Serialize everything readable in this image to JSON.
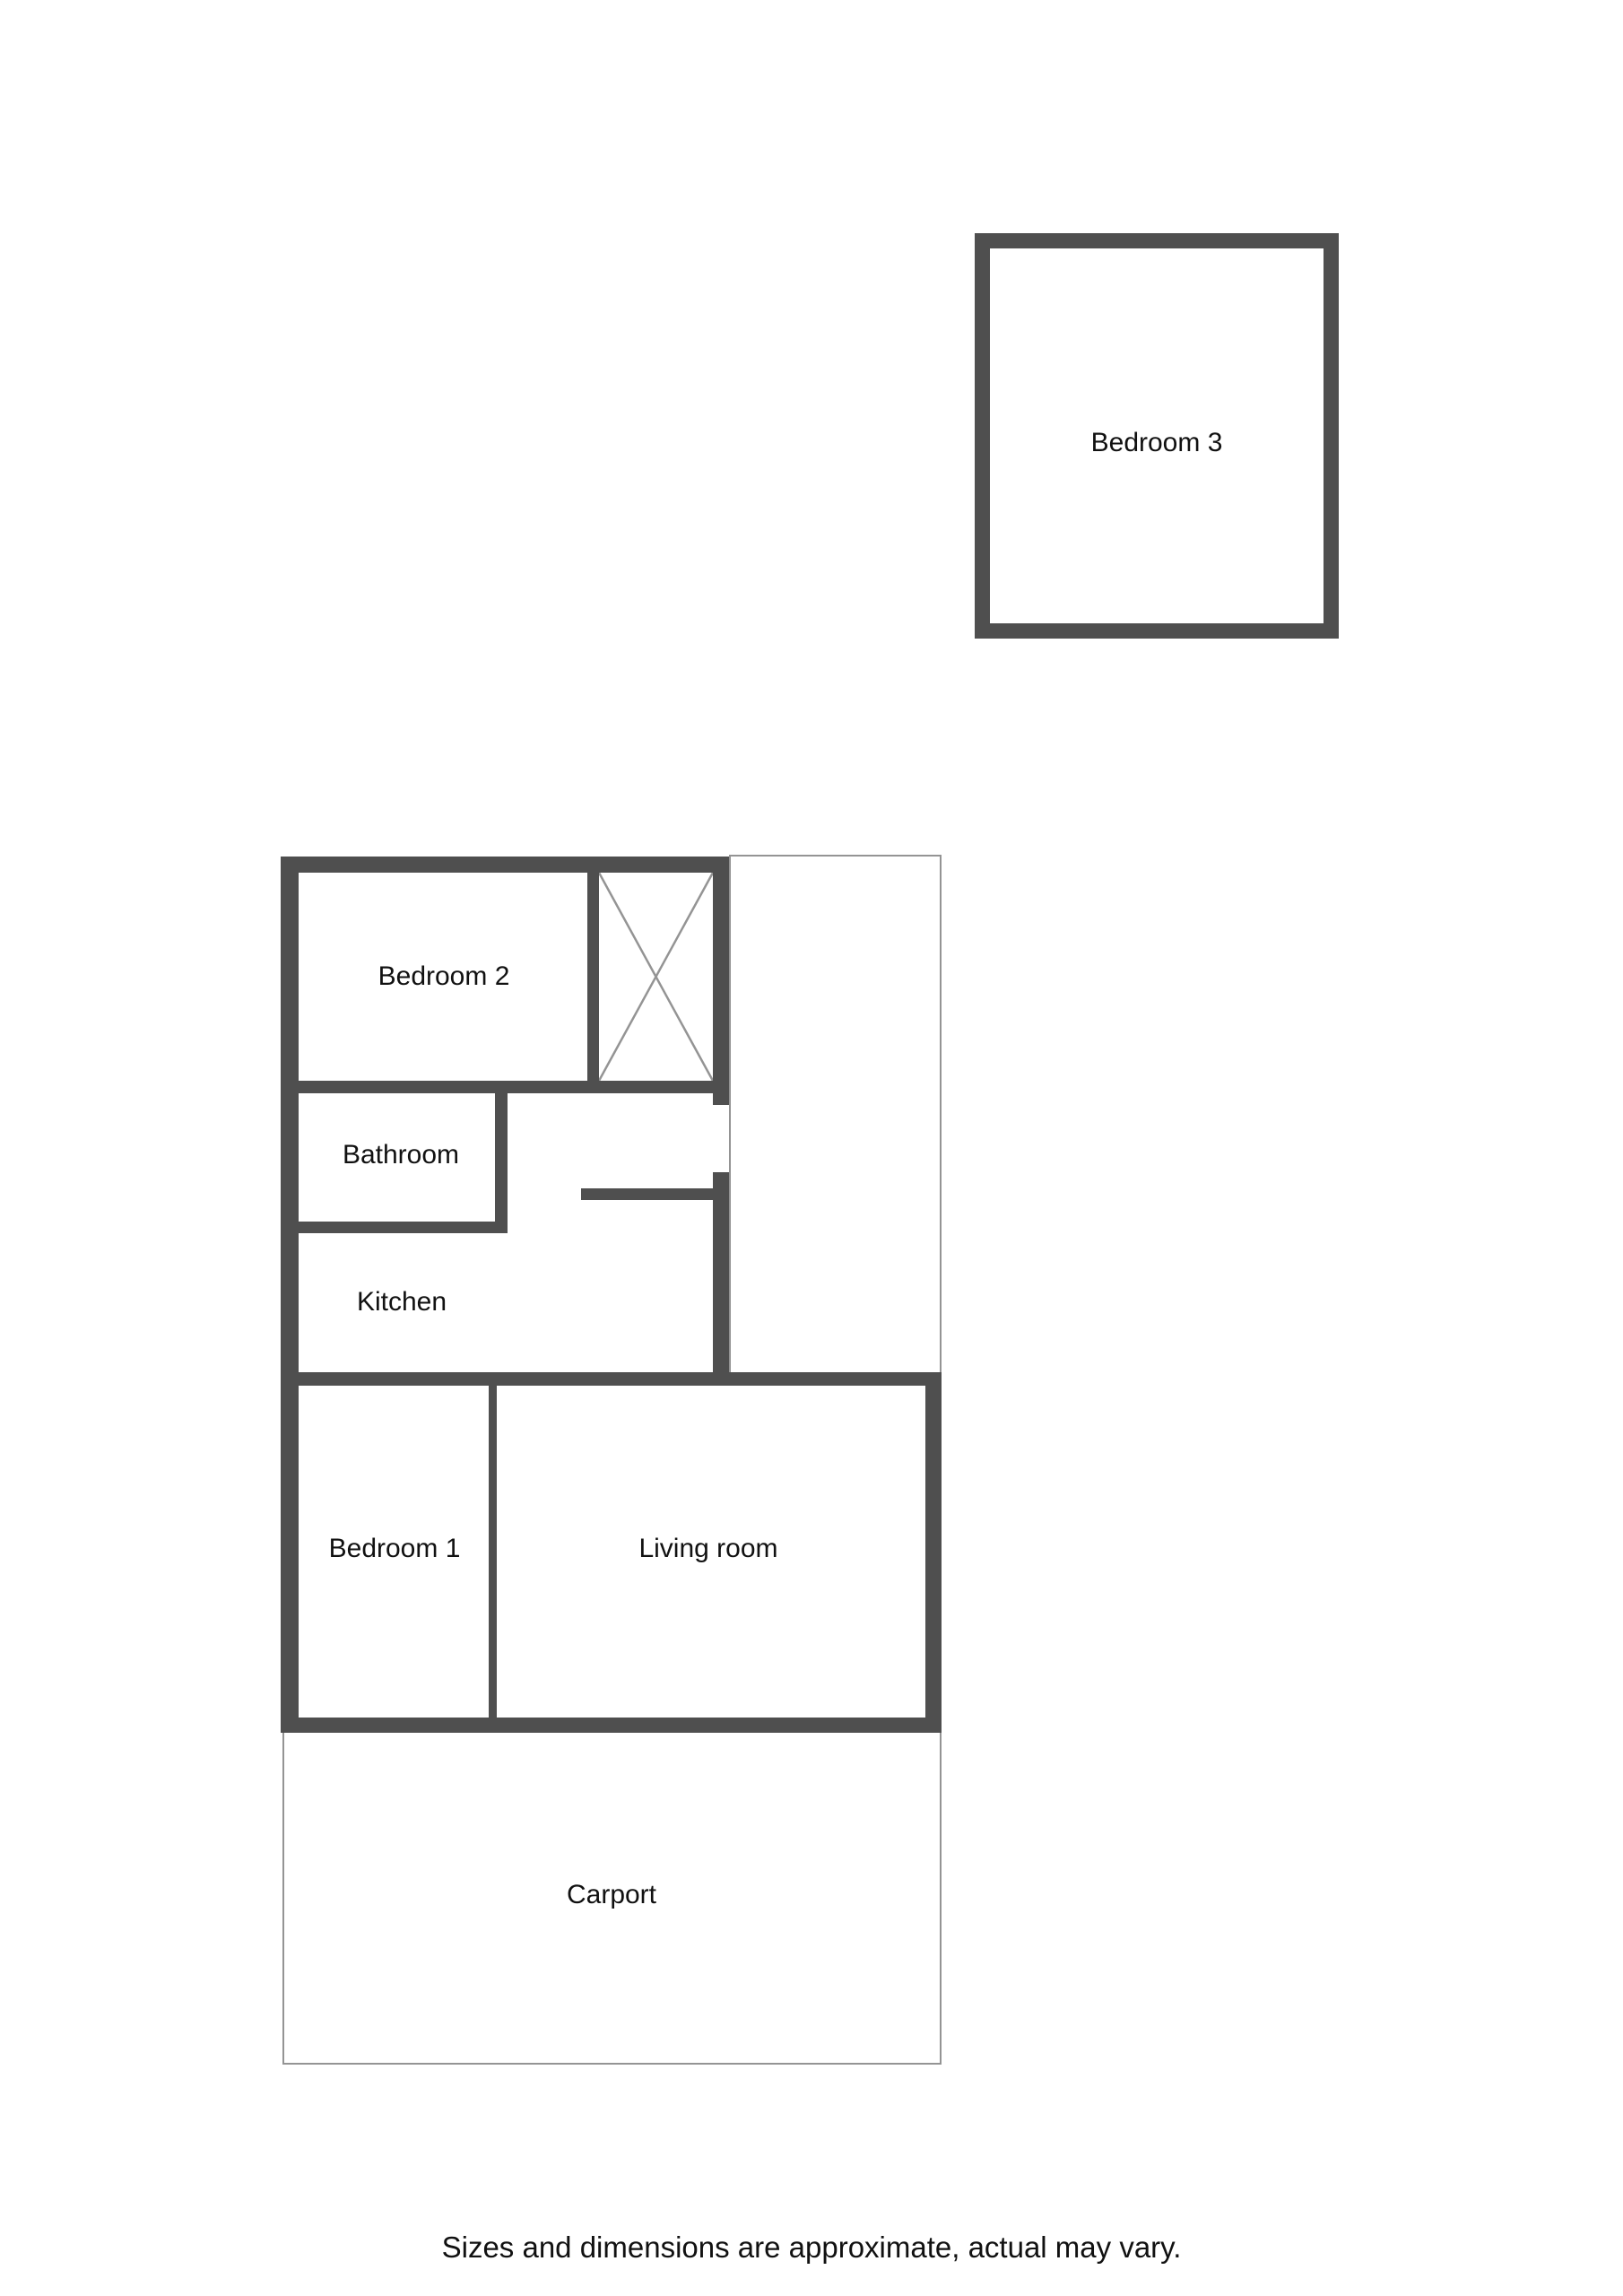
{
  "floorplan": {
    "rooms": [
      {
        "label": "Bedroom 3"
      },
      {
        "label": "Bedroom 2"
      },
      {
        "label": "Bathroom"
      },
      {
        "label": "Kitchen"
      },
      {
        "label": "Bedroom 1"
      },
      {
        "label": "Living room"
      },
      {
        "label": "Carport"
      }
    ],
    "footer_note": "Sizes and dimensions are approximate, actual may vary.",
    "icons": {
      "closet_cross": "diagonal-x-wardrobe-symbol"
    },
    "colors": {
      "wall": "#4f4f4f",
      "thin": "#949494",
      "text": "#111111",
      "bg": "#ffffff"
    }
  }
}
